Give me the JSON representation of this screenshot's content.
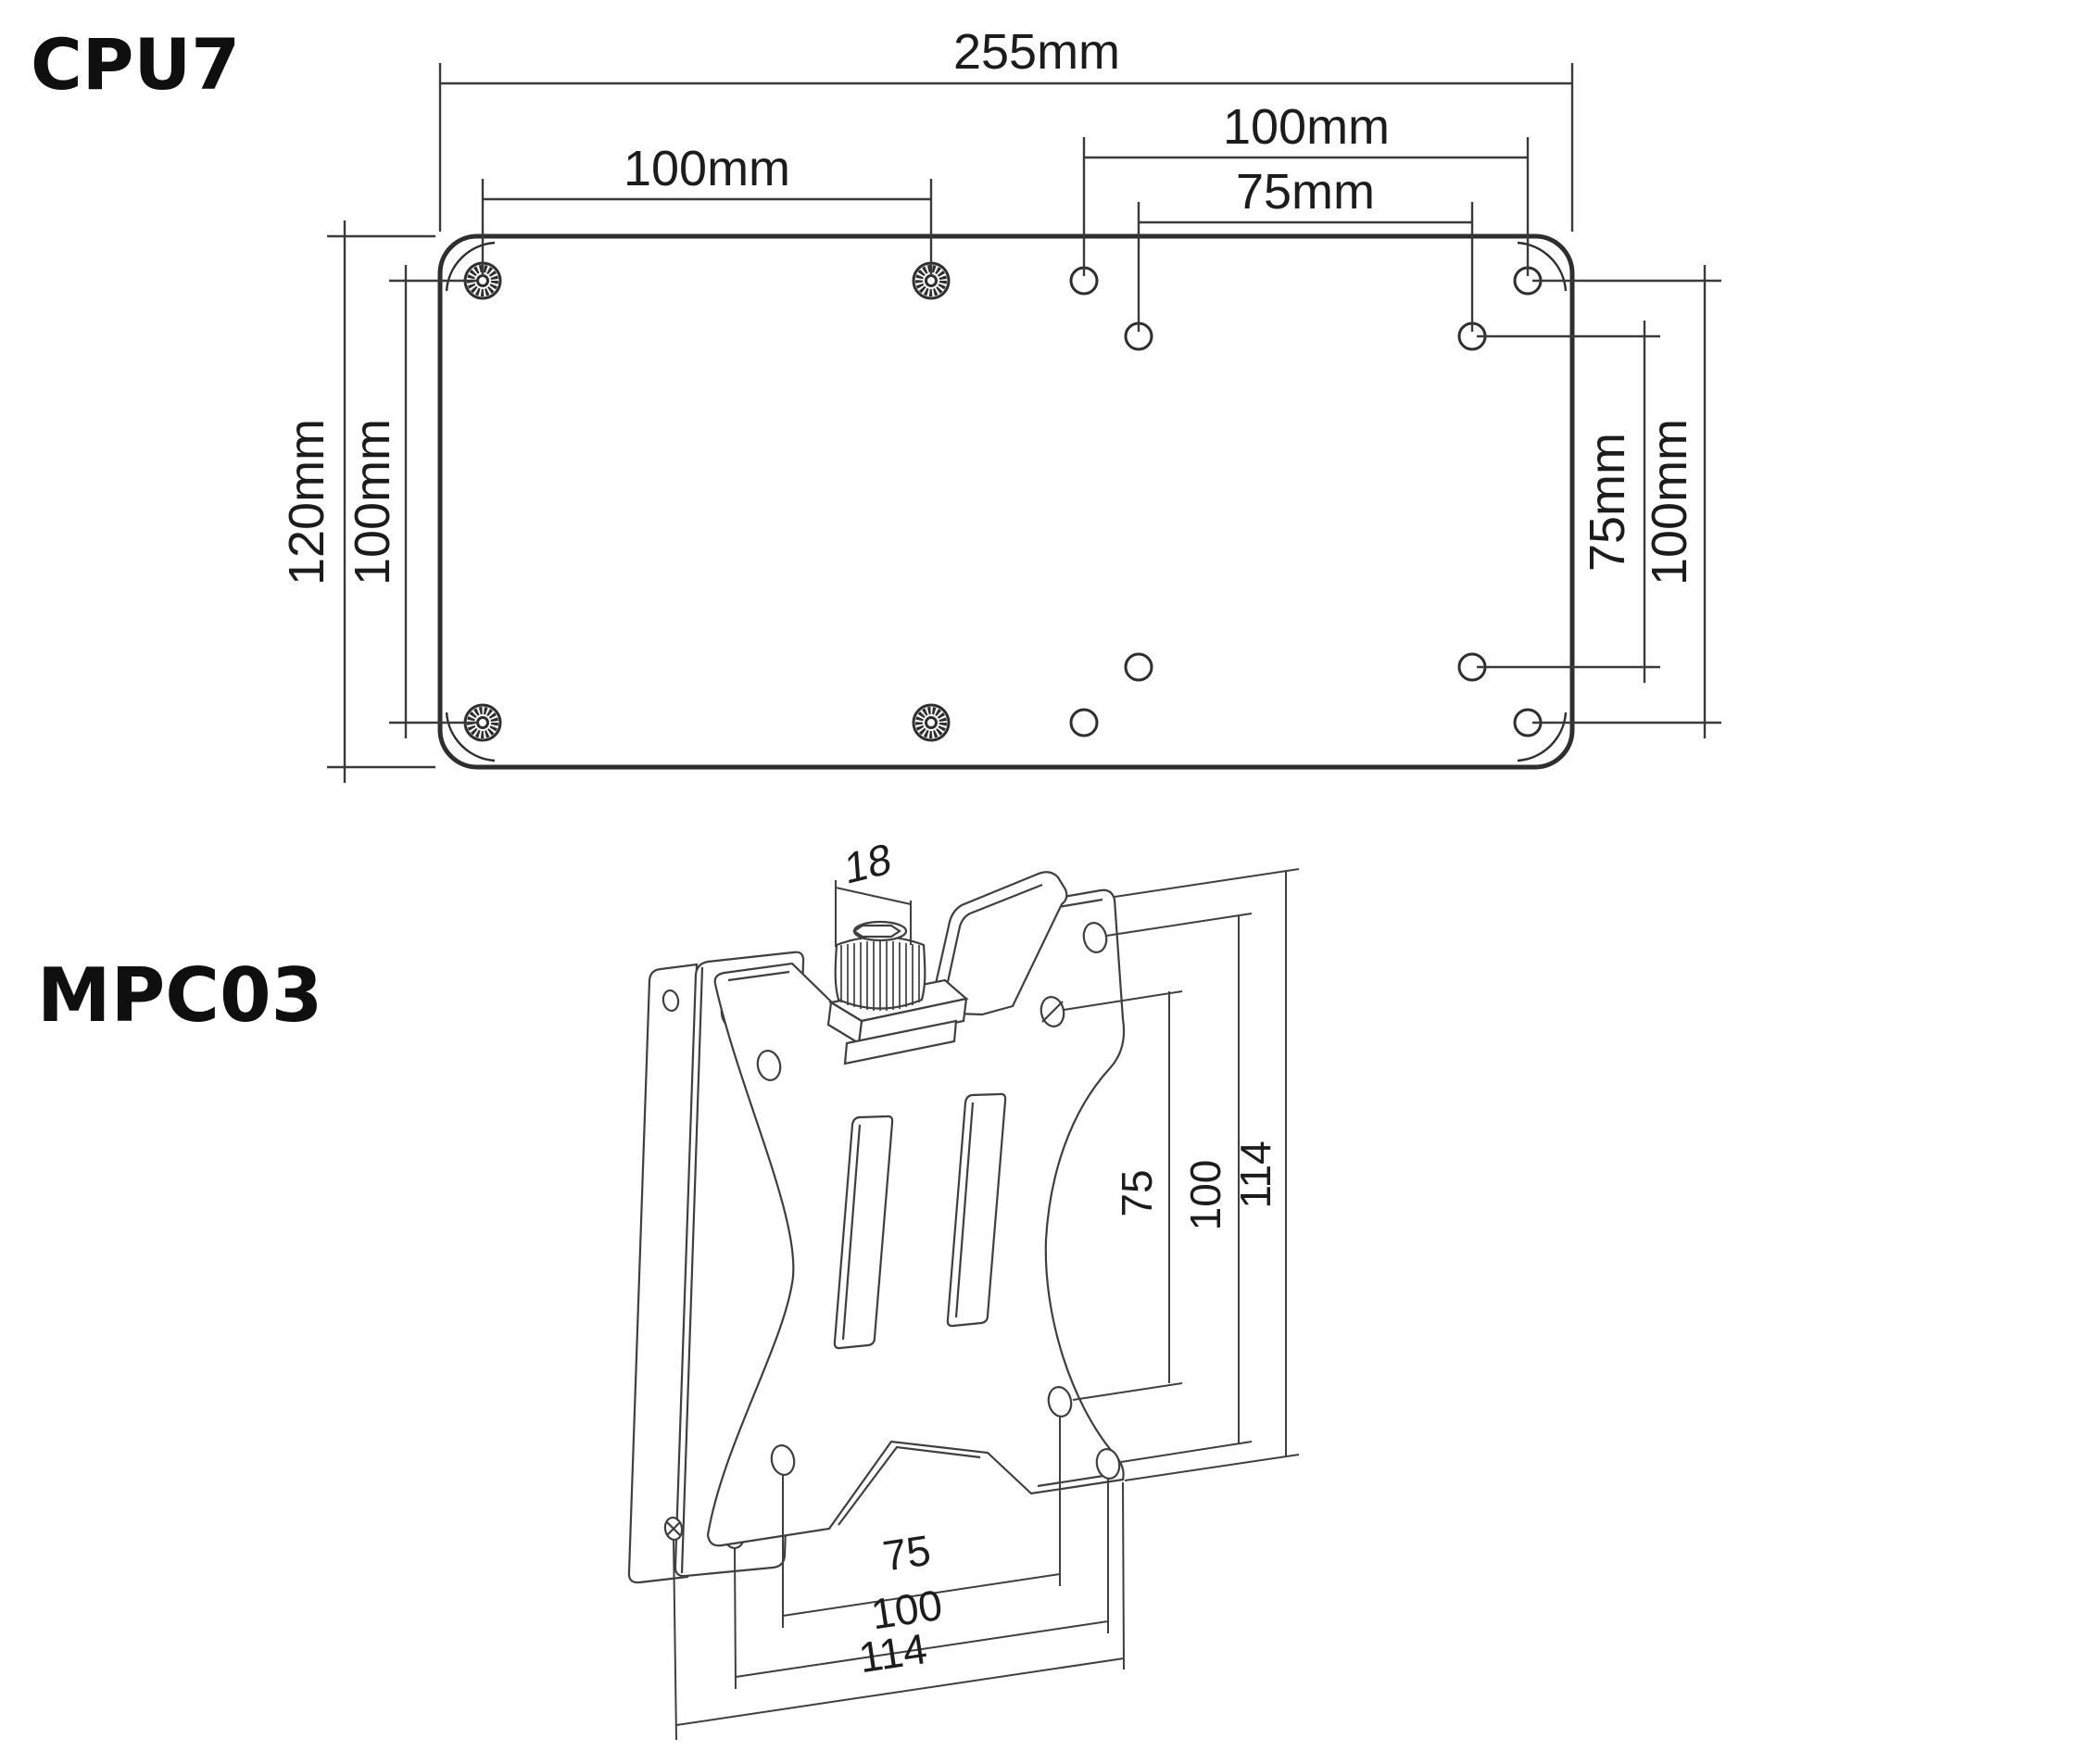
{
  "colors": {
    "background": "#ffffff",
    "line": "#2e2e2e",
    "dim_line": "#3a3a3a",
    "text": "#1c1c1c"
  },
  "cpu7": {
    "title": "CPU7",
    "dims": {
      "overall_width": "255mm",
      "left_pattern_width": "100mm",
      "right_outer_width": "100mm",
      "right_inner_width": "75mm",
      "overall_height": "120mm",
      "left_pattern_height": "100mm",
      "right_inner_height": "75mm",
      "right_outer_height": "100mm"
    }
  },
  "mpc03": {
    "title": "MPC03",
    "dims": {
      "knob_width": "18",
      "right_inner": "75",
      "right_middle": "100",
      "right_outer": "114",
      "bottom_inner": "75",
      "bottom_middle": "100",
      "bottom_outer": "114"
    }
  }
}
